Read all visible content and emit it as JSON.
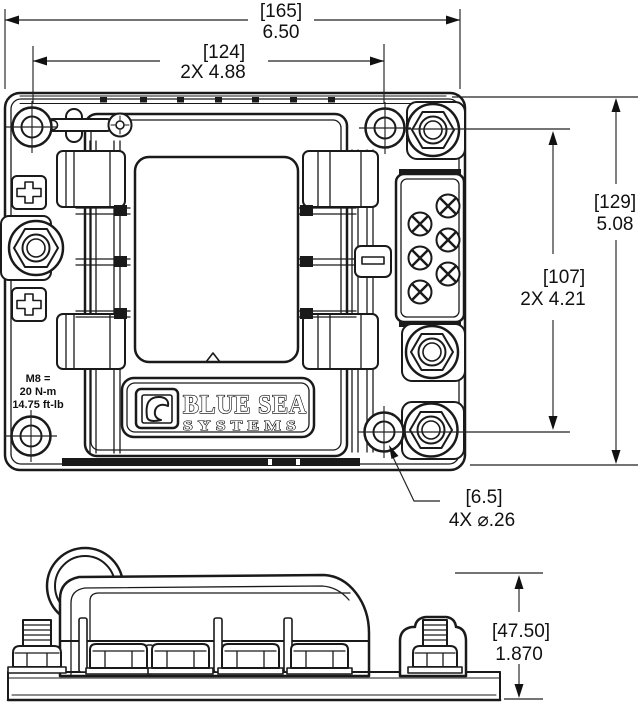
{
  "dims": {
    "overall_width": {
      "metric": "[165]",
      "inch": "6.50"
    },
    "hole_spacing_width": {
      "metric": "[124]",
      "inch": "2X  4.88"
    },
    "overall_height": {
      "metric": "[129]",
      "inch": "5.08"
    },
    "hole_spacing_height": {
      "metric": "[107]",
      "inch": "2X  4.21"
    },
    "mounting_holes": {
      "metric": "[6.5]",
      "inch": "4X ⌀.26"
    },
    "profile_height": {
      "metric": "[47.50]",
      "inch": "1.870"
    }
  },
  "notes": {
    "torque": [
      "M8 =",
      "20 N-m",
      "14.75 ft-lb"
    ]
  },
  "logo": {
    "title": "BLUE SEA",
    "subtitle": "SYSTEMS"
  },
  "icons": {
    "positive_terminal": "plus-icon",
    "negative_terminal": "minus-icon",
    "terminal_screws": "phillips-x-icon",
    "studs": "hex-nut-icon",
    "mounting_holes": "circle-crosshair-icon",
    "logo_mark": "blue-sea-wave-icon"
  },
  "colors": {
    "line": "#1a1a1a",
    "background": "#ffffff"
  }
}
